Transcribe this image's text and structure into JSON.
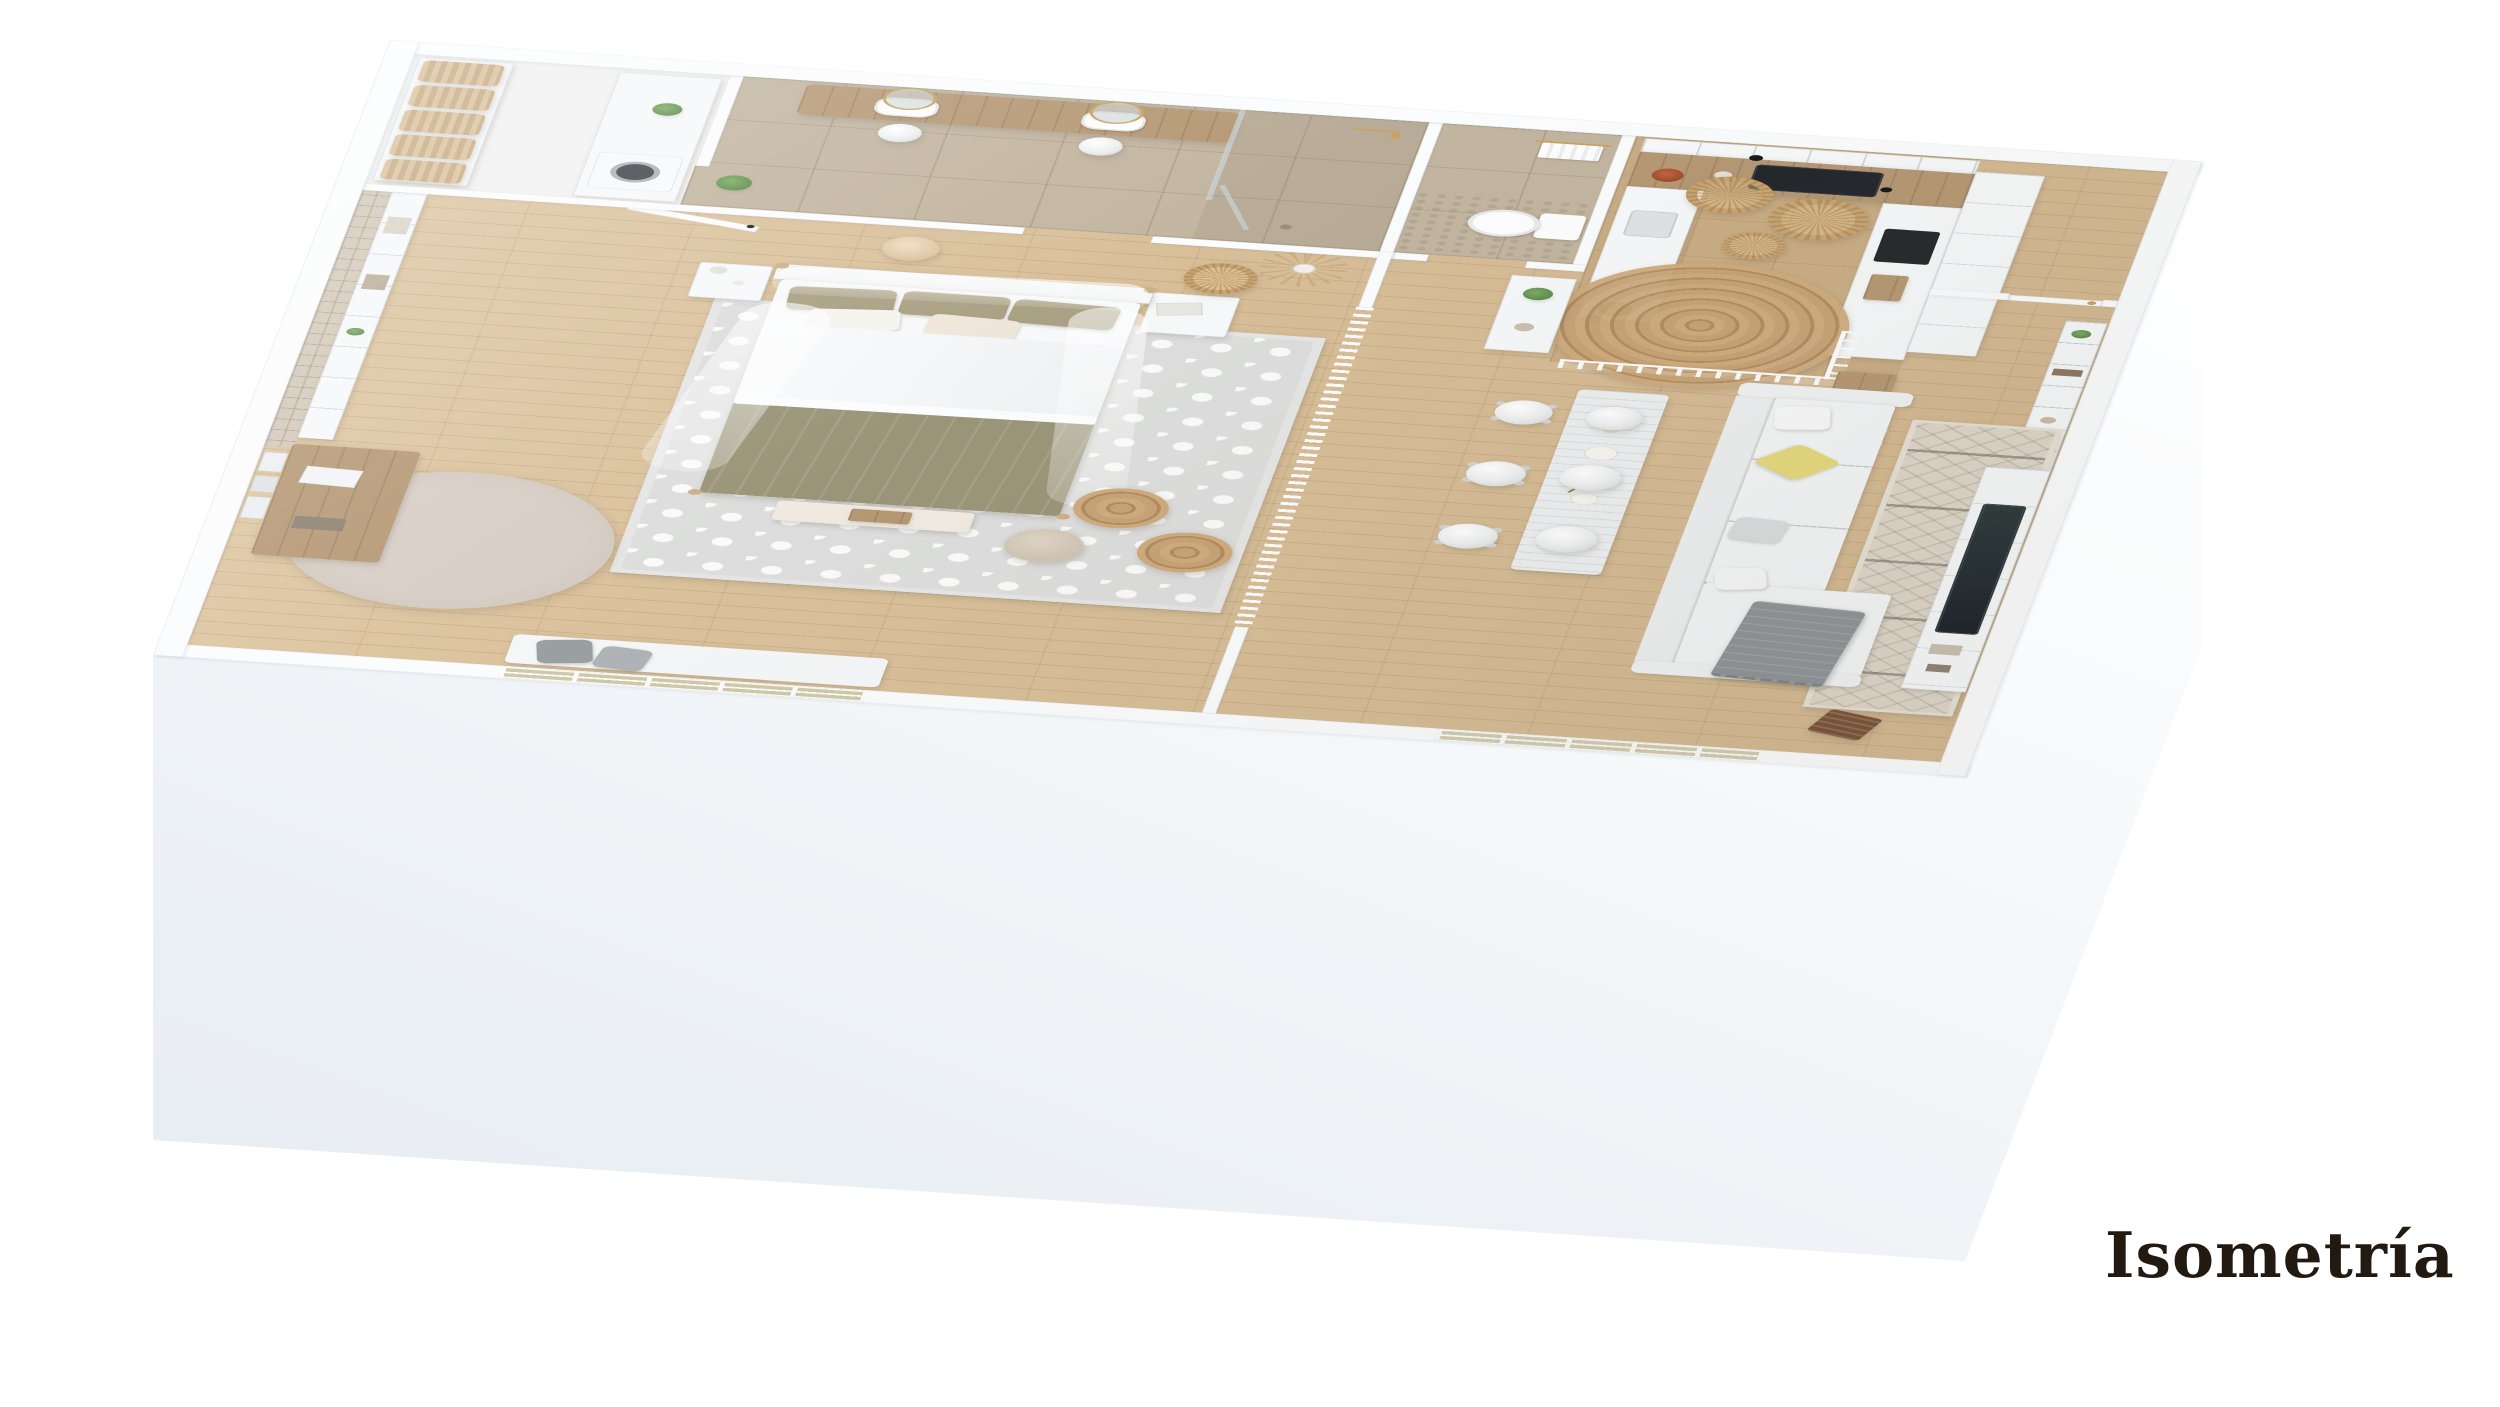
{
  "caption": {
    "title": "Isometría"
  },
  "scene": {
    "kind": "isometric-3d-floor-plan-render",
    "style": "white-scandinavian-studio-apartment",
    "view": "axonometric-top",
    "background": "white"
  },
  "palette": {
    "bg": "#ffffff",
    "wall": "#fbfcfd",
    "wallface": "#eef2f6",
    "wood": "#d9be95",
    "tile": "#c2b5a0",
    "kitchentile": "#c9ad84",
    "counter": "#b59874",
    "olive": "#9a9478",
    "yellow": "#e4d87d",
    "gray": "#8e9396",
    "jute": "#bd9c6f",
    "brick": "#d3c7b8",
    "ruggray": "#dcdddc",
    "rugboho": "#ddd5c7",
    "tv": "#232c33",
    "gold": "#c9a25e",
    "green": "#5f8f4e",
    "ink": "#221910"
  },
  "rooms": [
    {
      "id": "laundry-storage",
      "items": [
        "wicker-baskets-shelving",
        "white-counter",
        "washing-machine",
        "potted-plant"
      ]
    },
    {
      "id": "bathroom",
      "items": [
        "double-wood-vanity",
        "two-vessel-sinks",
        "two-round-gold-mirrors",
        "two-white-pendant-lamps",
        "glass-walk-in-shower",
        "gold-fixtures",
        "plant"
      ]
    },
    {
      "id": "wc",
      "items": [
        "toilet",
        "towel-rail-with-towel",
        "pebble-floor-strip"
      ]
    },
    {
      "id": "bedroom",
      "items": [
        "four-poster-canopy-bed",
        "olive-and-white-bedding",
        "two-nightstands",
        "rattan-pendant",
        "beige-pendant",
        "trellis-area-rug",
        "two-jute-poufs",
        "beige-pouf",
        "foot-bench-with-tray",
        "brick-accent-wall-with-shelves",
        "wall-desk-vanity",
        "round-beige-rug",
        "daybed-bench-with-gray-pillows",
        "pampas-grass-vase",
        "white-interior-door",
        "gridded-window"
      ]
    },
    {
      "id": "hallway",
      "items": [
        "white-slat-room-divider",
        "console-with-plant"
      ]
    },
    {
      "id": "kitchen",
      "items": [
        "white-upper-cabinets",
        "wood-countertop",
        "black-cooktop",
        "black-range-hood",
        "white-peninsula",
        "tall-cabinet-with-black-oven",
        "three-rattan-pendants",
        "round-jute-rug",
        "white-stair-railing",
        "terracotta-fruit-bowl",
        "bar-console-with-stool"
      ]
    },
    {
      "id": "entry",
      "items": [
        "white-panel-door-gold-handle",
        "tall-white-bookshelf",
        "plant"
      ]
    },
    {
      "id": "living-dining",
      "items": [
        "whitewashed-dining-table",
        "three-white-stools",
        "three-white-sphere-pendants",
        "white-sectional-sofa",
        "yellow-accent-pillow",
        "gray-throw-blanket",
        "boho-geometric-rug",
        "white-tv-media-wall",
        "flat-screen-tv",
        "dark-wood-chair",
        "gridded-window"
      ]
    }
  ]
}
